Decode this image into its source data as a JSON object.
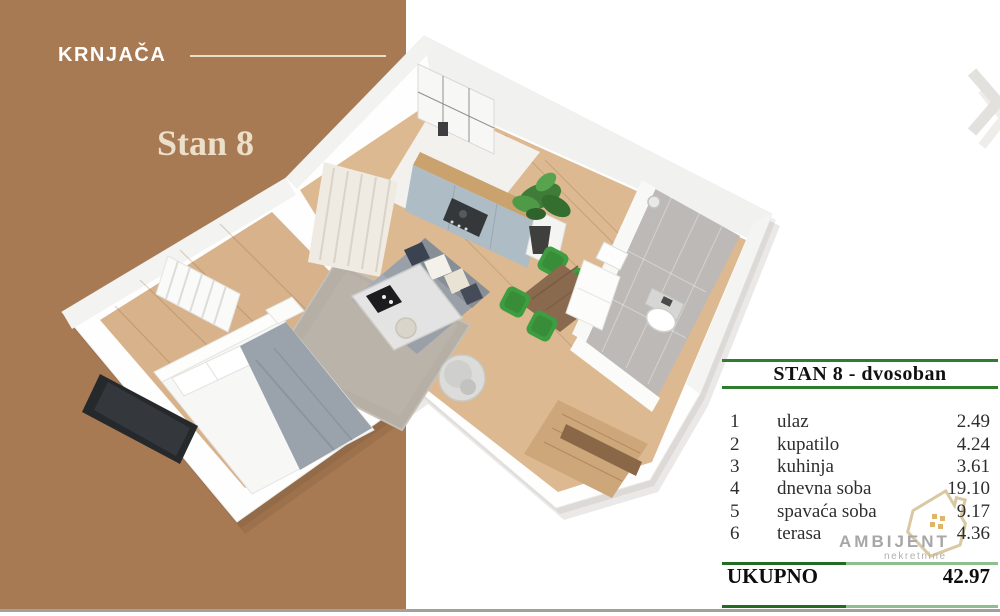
{
  "brand": {
    "location": "KRNJAČA",
    "unit": "Stan 8"
  },
  "table": {
    "title": "STAN 8 - dvosoban",
    "rows": [
      {
        "num": "1",
        "name": "ulaz",
        "area": "2.49"
      },
      {
        "num": "2",
        "name": "kupatilo",
        "area": "4.24"
      },
      {
        "num": "3",
        "name": "kuhinja",
        "area": "3.61"
      },
      {
        "num": "4",
        "name": "dnevna soba",
        "area": "19.10"
      },
      {
        "num": "5",
        "name": "spavaća soba",
        "area": "9.17"
      },
      {
        "num": "6",
        "name": "terasa",
        "area": "4.36"
      }
    ],
    "total_label": "UKUPNO",
    "total_value": "42.97"
  },
  "logo": {
    "name": "AMBIJENT",
    "subtitle": "nekretnine"
  },
  "colors": {
    "brand_brown": "#a77a53",
    "accent_cream": "#e8dcc4",
    "table_green": "#2e7d2e",
    "table_green_dark": "#236b23",
    "table_green_light": "#8fbf8f",
    "chair_green": "#3f9d41",
    "wood_floor": "#d7b28a",
    "logo_gray": "#a7a7a7",
    "house_gold": "#d9c8a2"
  }
}
